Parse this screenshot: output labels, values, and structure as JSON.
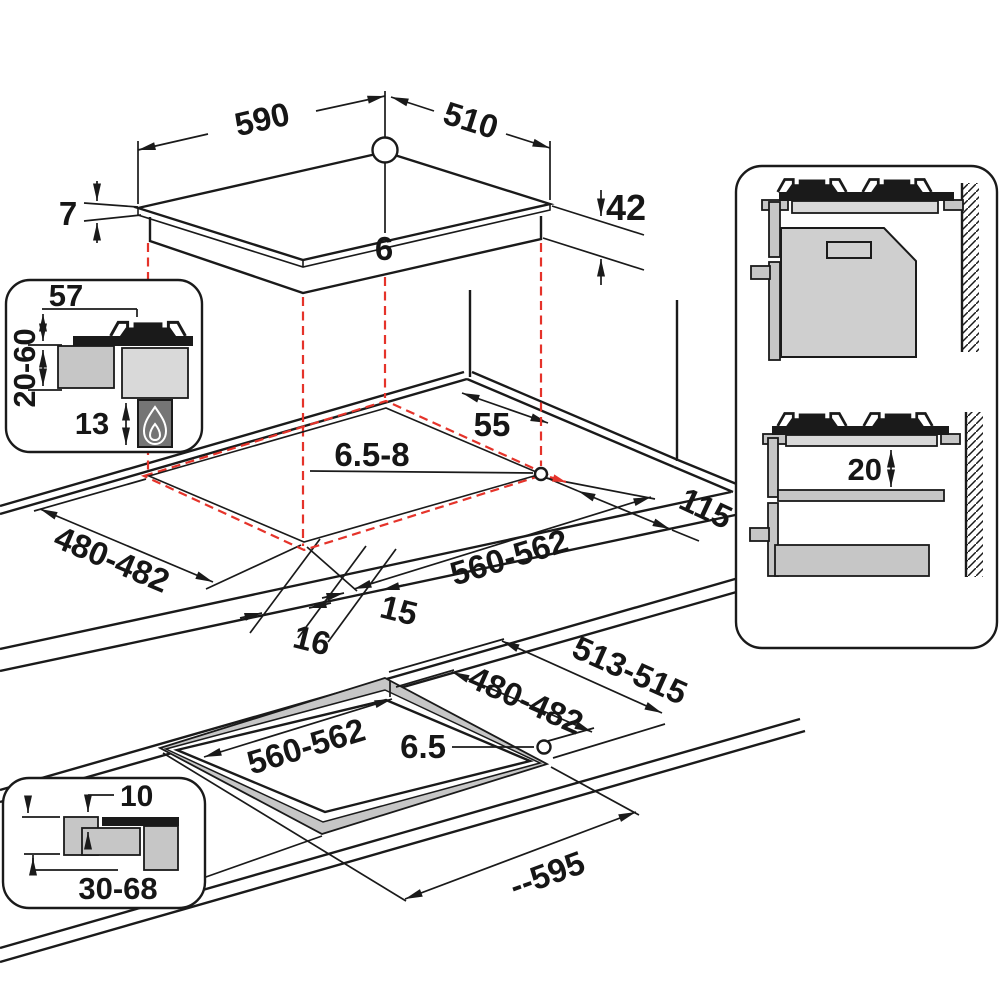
{
  "title": "Gas hob installation dimensions diagram",
  "units_note": "",
  "colors": {
    "line": "#1a1a1a",
    "red": "#e5332a",
    "gray_light": "#d9d9d9",
    "gray_mid": "#c6c6c6",
    "gray_oven": "#cfcfcf",
    "gray_dark": "#757575"
  },
  "labels": {
    "top_width": "590",
    "top_depth": "510",
    "hole_top": "6",
    "glass_thickness": "7",
    "body_height": "42",
    "inset_burner": "57",
    "inset_worktop": "20-60",
    "inset_clearance": "13",
    "cut_back": "55",
    "cut_hole": "6.5-8",
    "cut_side": "115",
    "cut_depth": "480-482",
    "cut_width": "560-562",
    "cut_front_inner": "15",
    "cut_front_outer": "16",
    "panel_gap": "20",
    "flush_outer": "513-515",
    "flush_depth": "480-482",
    "flush_width": "560-562",
    "flush_hole": "6.5",
    "flush_overall": "--595",
    "flush_step": "10",
    "flush_worktop": "30-68"
  }
}
